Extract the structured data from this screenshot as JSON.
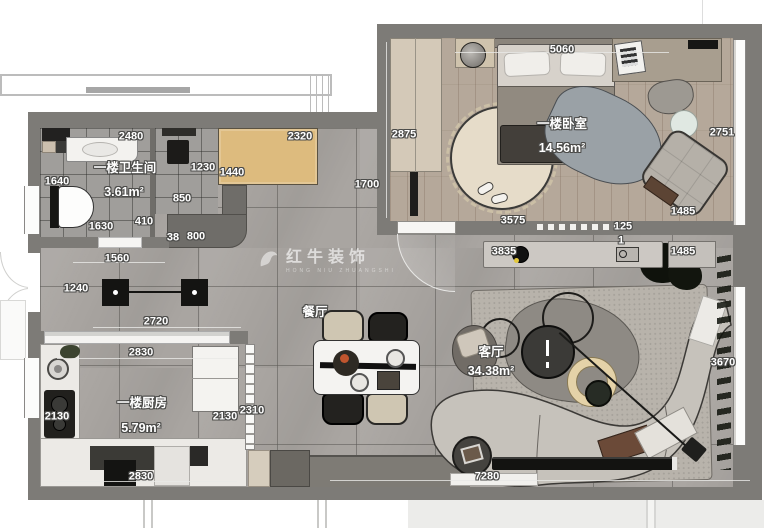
{
  "watermark": {
    "brand": "红牛装饰",
    "sub": "HONG NIU ZHUANGSHI"
  },
  "rooms": [
    {
      "name": "一楼卫生间",
      "area": "3.61m²"
    },
    {
      "name": "一楼卧室",
      "area": "14.56m²"
    },
    {
      "name": "一楼厨房",
      "area": "5.79m²"
    },
    {
      "name": "餐厅",
      "area": ""
    },
    {
      "name": "客厅",
      "area": "34.38m²"
    }
  ],
  "colors": {
    "wall": "#7d7b77",
    "floor_tile": "#a9a5a1",
    "wood_floor": "#b5a89a",
    "cabinet_wood": "#ddbb7e",
    "accent_yellow": "#e3c83c"
  },
  "annotations": [
    {
      "t": "2480",
      "x": 131,
      "y": 137,
      "c": "dim"
    },
    {
      "t": "2320",
      "x": 300,
      "y": 137,
      "c": "dim"
    },
    {
      "t": "2875",
      "x": 404,
      "y": 135,
      "c": "dim"
    },
    {
      "t": "5060",
      "x": 562,
      "y": 50,
      "c": "dim"
    },
    {
      "t": "2751",
      "x": 722,
      "y": 133,
      "c": "dim"
    },
    {
      "t": "1640",
      "x": 57,
      "y": 182,
      "c": "dim"
    },
    {
      "t": "1230",
      "x": 203,
      "y": 168,
      "c": "dim"
    },
    {
      "t": "1440",
      "x": 232,
      "y": 173,
      "c": "dim"
    },
    {
      "t": "1700",
      "x": 367,
      "y": 185,
      "c": "dim"
    },
    {
      "t": "850",
      "x": 182,
      "y": 199,
      "c": "dim"
    },
    {
      "t": "410",
      "x": 144,
      "y": 222,
      "c": "dim"
    },
    {
      "t": "1630",
      "x": 101,
      "y": 227,
      "c": "dim"
    },
    {
      "t": "38",
      "x": 173,
      "y": 238,
      "c": "dim"
    },
    {
      "t": "800",
      "x": 196,
      "y": 237,
      "c": "dim"
    },
    {
      "t": "1560",
      "x": 117,
      "y": 259,
      "c": "dim"
    },
    {
      "t": "1240",
      "x": 76,
      "y": 289,
      "c": "dim"
    },
    {
      "t": "3575",
      "x": 513,
      "y": 221,
      "c": "dim"
    },
    {
      "t": "125",
      "x": 623,
      "y": 227,
      "c": "dim"
    },
    {
      "t": "1",
      "x": 621,
      "y": 241,
      "c": "dim"
    },
    {
      "t": "1485",
      "x": 683,
      "y": 212,
      "c": "dim"
    },
    {
      "t": "3835",
      "x": 504,
      "y": 252,
      "c": "dim"
    },
    {
      "t": "1485",
      "x": 683,
      "y": 252,
      "c": "dim"
    },
    {
      "t": "2720",
      "x": 156,
      "y": 322,
      "c": "dim"
    },
    {
      "t": "2830",
      "x": 141,
      "y": 353,
      "c": "dim"
    },
    {
      "t": "3670",
      "x": 723,
      "y": 363,
      "c": "dim"
    },
    {
      "t": "2130",
      "x": 57,
      "y": 417,
      "c": "dim"
    },
    {
      "t": "2130",
      "x": 225,
      "y": 417,
      "c": "dim"
    },
    {
      "t": "2310",
      "x": 252,
      "y": 411,
      "c": "dim"
    },
    {
      "t": "2830",
      "x": 141,
      "y": 477,
      "c": "dim"
    },
    {
      "t": "7280",
      "x": 487,
      "y": 477,
      "c": "dim"
    },
    {
      "t": "一楼卫生间",
      "x": 125,
      "y": 168,
      "c": "room"
    },
    {
      "t": "3.61m²",
      "x": 124,
      "y": 192,
      "c": "area"
    },
    {
      "t": "一楼卧室",
      "x": 562,
      "y": 124,
      "c": "room"
    },
    {
      "t": "14.56m²",
      "x": 562,
      "y": 148,
      "c": "area"
    },
    {
      "t": "一楼厨房",
      "x": 142,
      "y": 403,
      "c": "room"
    },
    {
      "t": "5.79m²",
      "x": 141,
      "y": 428,
      "c": "area"
    },
    {
      "t": "餐厅",
      "x": 315,
      "y": 312,
      "c": "room"
    },
    {
      "t": "客厅",
      "x": 491,
      "y": 352,
      "c": "room"
    },
    {
      "t": "34.38m²",
      "x": 491,
      "y": 371,
      "c": "area"
    }
  ]
}
